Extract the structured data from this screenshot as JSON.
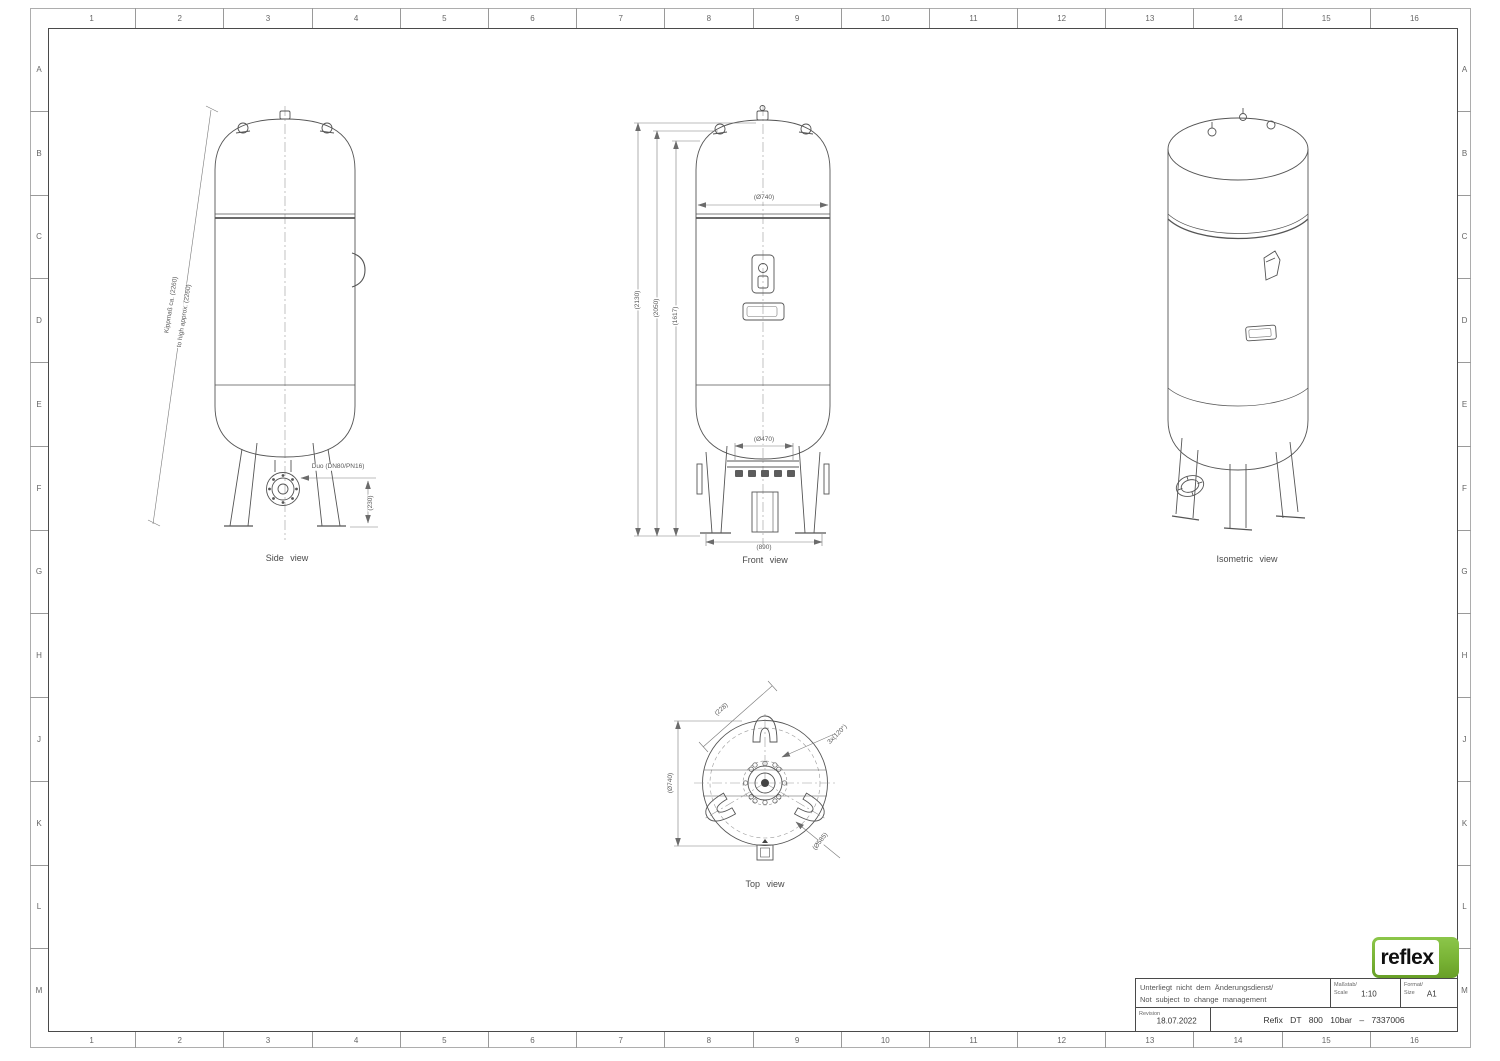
{
  "sheet": {
    "grid_columns": [
      "1",
      "2",
      "3",
      "4",
      "5",
      "6",
      "7",
      "8",
      "9",
      "10",
      "11",
      "12",
      "13",
      "14",
      "15",
      "16"
    ],
    "grid_rows": [
      "A",
      "B",
      "C",
      "D",
      "E",
      "F",
      "G",
      "H",
      "J",
      "K",
      "L",
      "M"
    ]
  },
  "views": {
    "side": {
      "label": "Side view",
      "dim_tilt_de": "Kippmaß ca. (2260)",
      "dim_tilt_en": "to high approx. (2260)",
      "dim_connection": "Duo (DN80/PN16)",
      "dim_flange_height": "(230)"
    },
    "front": {
      "label": "Front view",
      "dim_diameter": "(Ø740)",
      "dim_total_height": "(2130)",
      "dim_height_2": "(2050)",
      "dim_height_3": "(1617)",
      "dim_support_circle": "(Ø470)",
      "dim_leg_span": "(890)"
    },
    "isometric": {
      "label": "Isometric view"
    },
    "top": {
      "label": "Top view",
      "dim_diameter": "(Ø740)",
      "dim_lug_offset": "(228)",
      "dim_lug_pitch": "3x(120°)",
      "dim_bolt_circle": "(Ø585)"
    }
  },
  "title_block": {
    "note_line1": "Unterliegt nicht dem Änderungsdienst/",
    "note_line2": "Not subject to change management",
    "scale_label_line1": "Maßstab/",
    "scale_label_line2": "Scale",
    "scale_value": "1:10",
    "format_label_line1": "Format/",
    "format_label_line2": "Size",
    "format_value": "A1",
    "revision_label": "Revision",
    "revision_value": "18.07.2022",
    "drawing_title": "Refix DT 800 10bar – 7337006"
  },
  "logo": {
    "text": "reflex",
    "color_green": "#7cb637"
  }
}
